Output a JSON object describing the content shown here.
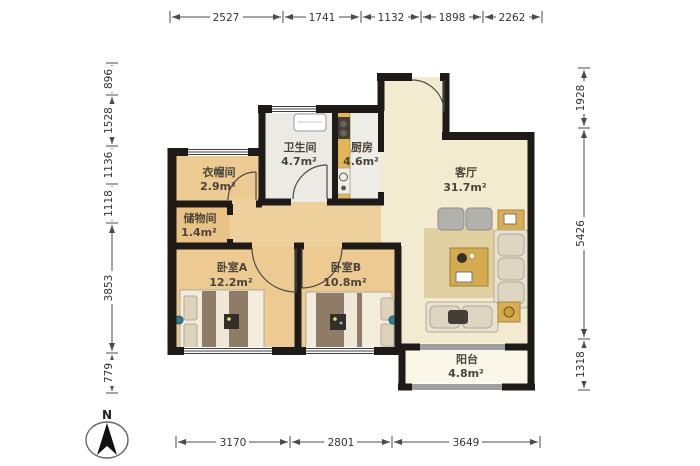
{
  "plan": {
    "compass_label": "N",
    "rooms": {
      "bathroom": {
        "name": "卫生间",
        "area": "4.7m²"
      },
      "kitchen": {
        "name": "厨房",
        "area": "4.6m²"
      },
      "living_room": {
        "name": "客厅",
        "area": "31.7m²"
      },
      "cloakroom": {
        "name": "衣帽间",
        "area": "2.9m²"
      },
      "storage": {
        "name": "储物间",
        "area": "1.4m²"
      },
      "bedroom_a": {
        "name": "卧室A",
        "area": "12.2m²"
      },
      "bedroom_b": {
        "name": "卧室B",
        "area": "10.8m²"
      },
      "balcony": {
        "name": "阳台",
        "area": "4.8m²"
      }
    },
    "dimensions_mm": {
      "top": [
        "2527",
        "1741",
        "1132",
        "1898",
        "2262"
      ],
      "bottom": [
        "3170",
        "2801",
        "3649"
      ],
      "left": [
        "896",
        "1528",
        "1136",
        "1118",
        "3853",
        "779"
      ],
      "right": [
        "1928",
        "5426",
        "1318"
      ]
    },
    "colors": {
      "wall": "#1d1a17",
      "floor_warm": "#ecca92",
      "floor_living": "#f2ebcf",
      "floor_wet": "#eceae4",
      "floor_balcony": "#faf6e8",
      "kitchen_counter": "#e3b558",
      "rug": "#e0cfa0",
      "sofa": "#e9e2cf",
      "bed_duvet": "#8f7c66"
    }
  }
}
